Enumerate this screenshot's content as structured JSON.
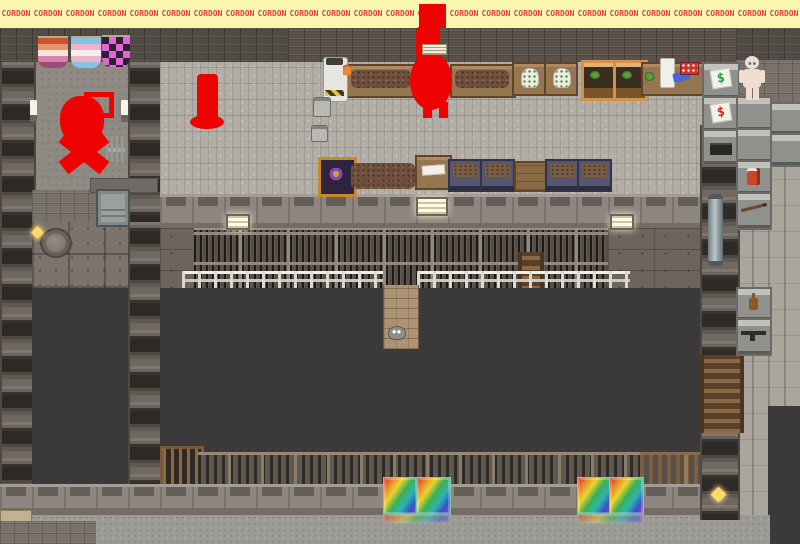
{
  "banner": {
    "label": "CORDON",
    "count": 25,
    "text_color": "#e04343",
    "bg_color": "#faf6ae"
  },
  "annotations": {
    "color": "#ee0202",
    "items": [
      {
        "name": "redacted-player-left",
        "shape": "scribbled figure with square outline and X body"
      },
      {
        "name": "red-pillar-marker",
        "shape": "vertical bar with flared base"
      },
      {
        "name": "redacted-player-top",
        "shape": "large blob covering stall, extends over banner"
      }
    ]
  },
  "flags": [
    {
      "name": "lesbian-pride-flag",
      "colors": [
        "#c9542f",
        "#e8936a",
        "#f2e6da",
        "#d883ae",
        "#a04a78"
      ]
    },
    {
      "name": "trans-pride-flag",
      "colors": [
        "#84c3e6",
        "#efb3ca",
        "#f4f0ec",
        "#efb3ca",
        "#84c3e6"
      ]
    },
    {
      "name": "pink-checker-flag",
      "colors": [
        "#e565d8",
        "#2c2135"
      ]
    }
  ],
  "shops": {
    "green_sign_text": "$",
    "green_sign_color": "#1f9e3a",
    "red_sign_text": "$",
    "red_sign_color": "#cf2222"
  },
  "markers": {
    "color": "#ffd866",
    "locations": [
      "manhole",
      "south-pillar"
    ]
  },
  "rainbow_tiles": {
    "count": 4,
    "gradient": [
      "#d22626",
      "#e8832a",
      "#ecd32e",
      "#3cb054",
      "#2fb3b3",
      "#3352c8",
      "#b238c0"
    ]
  }
}
